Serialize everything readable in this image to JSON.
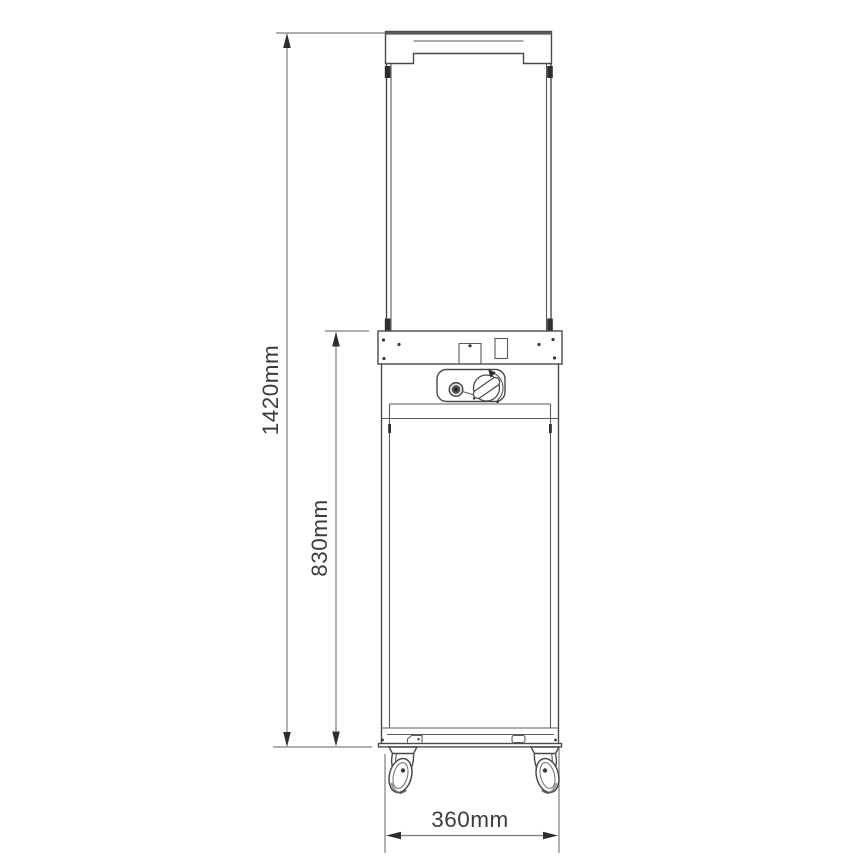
{
  "diagram": {
    "dimensions": {
      "total_height": "1420mm",
      "body_height": "830mm",
      "width": "360mm"
    },
    "colors": {
      "outline": "#4a4a4a",
      "dimension_line": "#7d7d7d",
      "label_text": "#3c3c3c",
      "background": "#ffffff"
    }
  }
}
